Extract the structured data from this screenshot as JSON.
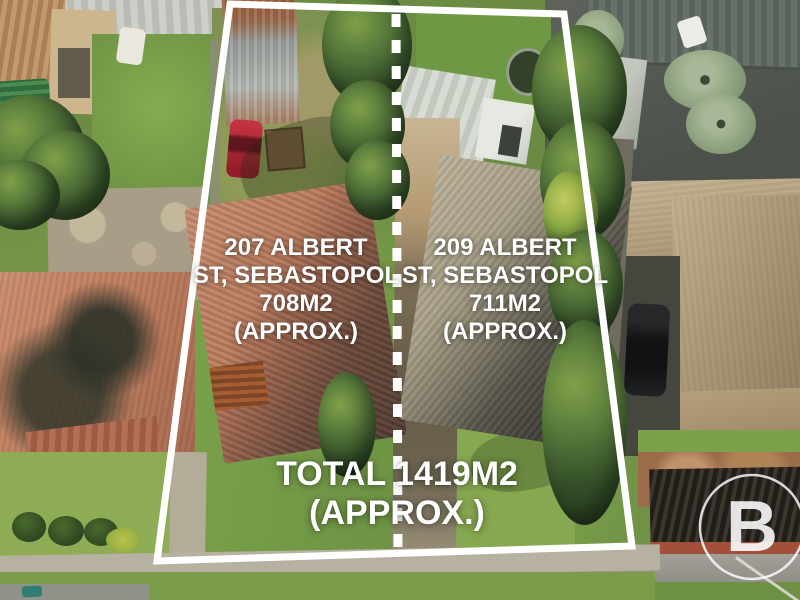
{
  "overlay": {
    "colors": {
      "boundary": "#ffffff",
      "text": "#ffffff"
    },
    "lot_left": {
      "lines": [
        "207 ALBERT",
        "ST, SEBASTOPOL",
        "708M2",
        "(APPROX.)"
      ]
    },
    "lot_right": {
      "lines": [
        "209 ALBERT",
        "ST, SEBASTOPOL",
        "711M2",
        "(APPROX.)"
      ]
    },
    "total": {
      "lines": [
        "TOTAL 1419M2",
        "(APPROX.)"
      ]
    },
    "watermark": {
      "letter": "B"
    }
  }
}
